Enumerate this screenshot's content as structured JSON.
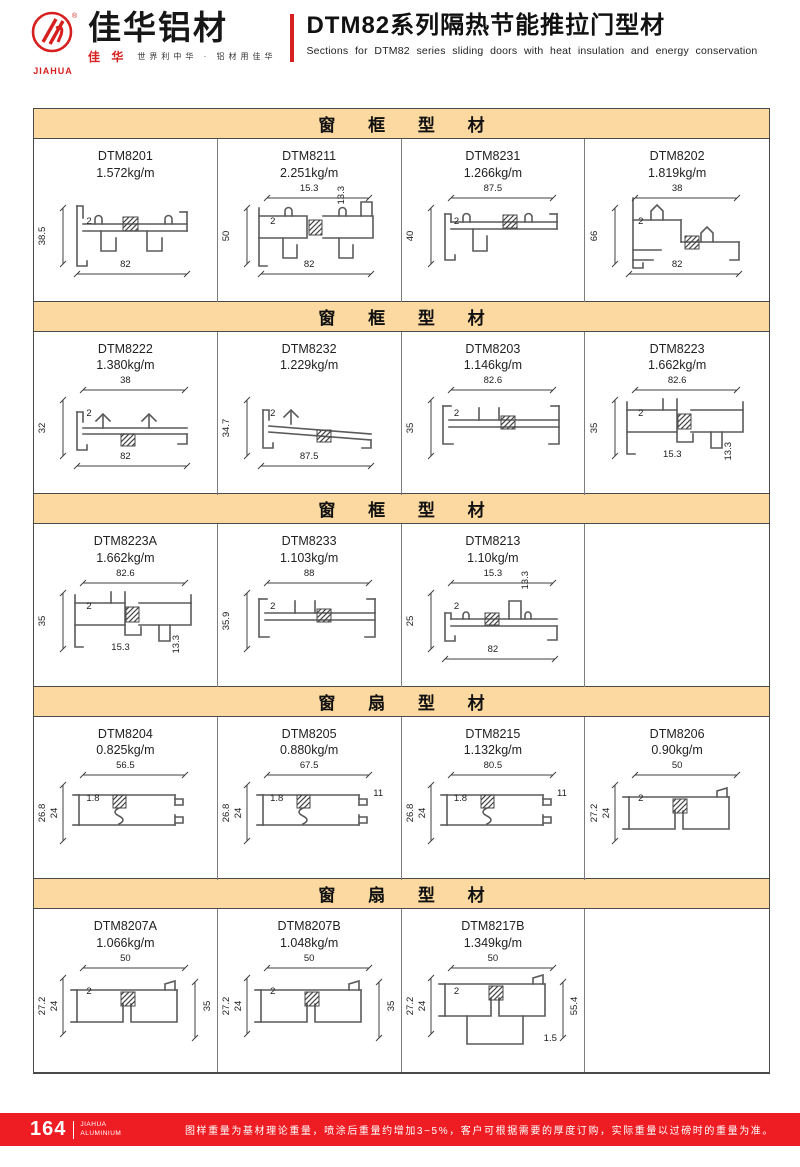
{
  "header": {
    "brand_en": "JIAHUA",
    "brand_cn": "佳华铝材",
    "brand_mark_cn": "佳 华",
    "tagline": "世界利中华 · 铝材用佳华",
    "title_cn": "DTM82系列隔热节能推拉门型材",
    "title_en": "Sections for DTM82 series sliding doors with heat insulation and energy conservation"
  },
  "sections": [
    {
      "title": "窗 框 型 材",
      "cells": [
        {
          "model": "DTM8201",
          "weight": "1.572kg/m",
          "shape": "trackA",
          "dims": [
            {
              "pos": "left",
              "v": "38.5"
            },
            {
              "pos": "inner",
              "v": "2"
            },
            {
              "pos": "bottom",
              "v": "82"
            }
          ]
        },
        {
          "model": "DTM8211",
          "weight": "2.251kg/m",
          "shape": "sillTop",
          "dims": [
            {
              "pos": "top",
              "v": "15.3"
            },
            {
              "pos": "top2",
              "v": "13.3"
            },
            {
              "pos": "inner",
              "v": "2"
            },
            {
              "pos": "left",
              "v": "50"
            },
            {
              "pos": "bottom",
              "v": "82"
            }
          ]
        },
        {
          "model": "DTM8231",
          "weight": "1.266kg/m",
          "shape": "trackB",
          "dims": [
            {
              "pos": "top",
              "v": "87.5"
            },
            {
              "pos": "inner",
              "v": "2"
            },
            {
              "pos": "left",
              "v": "40"
            }
          ]
        },
        {
          "model": "DTM8202",
          "weight": "1.819kg/m",
          "shape": "stepTall",
          "dims": [
            {
              "pos": "top",
              "v": "38"
            },
            {
              "pos": "left",
              "v": "66"
            },
            {
              "pos": "inner",
              "v": "2"
            },
            {
              "pos": "bottom",
              "v": "82"
            }
          ]
        }
      ]
    },
    {
      "title": "窗 框 型 材",
      "cells": [
        {
          "model": "DTM8222",
          "weight": "1.380kg/m",
          "shape": "sillArrows",
          "dims": [
            {
              "pos": "top",
              "v": "38"
            },
            {
              "pos": "inner",
              "v": "2"
            },
            {
              "pos": "left",
              "v": "32"
            },
            {
              "pos": "bottom",
              "v": "82"
            }
          ]
        },
        {
          "model": "DTM8232",
          "weight": "1.229kg/m",
          "shape": "sillSlope",
          "dims": [
            {
              "pos": "left",
              "v": "34.7"
            },
            {
              "pos": "inner",
              "v": "2"
            },
            {
              "pos": "bottom",
              "v": "87.5"
            }
          ]
        },
        {
          "model": "DTM8203",
          "weight": "1.146kg/m",
          "shape": "flatWide",
          "dims": [
            {
              "pos": "top",
              "v": "82.6"
            },
            {
              "pos": "left",
              "v": "35"
            },
            {
              "pos": "inner",
              "v": "2"
            }
          ]
        },
        {
          "model": "DTM8223",
          "weight": "1.662kg/m",
          "shape": "boxNotch",
          "dims": [
            {
              "pos": "top",
              "v": "82.6"
            },
            {
              "pos": "left",
              "v": "35"
            },
            {
              "pos": "inner",
              "v": "2"
            },
            {
              "pos": "bottom2",
              "v": "15.3"
            },
            {
              "pos": "right2",
              "v": "13.3"
            }
          ]
        }
      ]
    },
    {
      "title": "窗 框 型 材",
      "cells": [
        {
          "model": "DTM8223A",
          "weight": "1.662kg/m",
          "shape": "boxNotch",
          "dims": [
            {
              "pos": "top",
              "v": "82.6"
            },
            {
              "pos": "left",
              "v": "35"
            },
            {
              "pos": "inner",
              "v": "2"
            },
            {
              "pos": "bottom2",
              "v": "15.3"
            },
            {
              "pos": "right2",
              "v": "13.3"
            }
          ]
        },
        {
          "model": "DTM8233",
          "weight": "1.103kg/m",
          "shape": "flatWide",
          "dims": [
            {
              "pos": "top",
              "v": "88"
            },
            {
              "pos": "left",
              "v": "35.9"
            },
            {
              "pos": "inner",
              "v": "2"
            }
          ]
        },
        {
          "model": "DTM8213",
          "weight": "1.10kg/m",
          "shape": "trackLow",
          "dims": [
            {
              "pos": "top",
              "v": "15.3"
            },
            {
              "pos": "top2",
              "v": "13.3"
            },
            {
              "pos": "left",
              "v": "25"
            },
            {
              "pos": "inner",
              "v": "2"
            },
            {
              "pos": "bottom",
              "v": "82"
            }
          ]
        }
      ]
    },
    {
      "title": "窗 扇 型 材",
      "cells": [
        {
          "model": "DTM8204",
          "weight": "0.825kg/m",
          "shape": "sashRail",
          "dims": [
            {
              "pos": "top",
              "v": "56.5"
            },
            {
              "pos": "left",
              "v": "26.8"
            },
            {
              "pos": "left2",
              "v": "24"
            },
            {
              "pos": "inner",
              "v": "1.8"
            }
          ]
        },
        {
          "model": "DTM8205",
          "weight": "0.880kg/m",
          "shape": "sashRail",
          "dims": [
            {
              "pos": "top",
              "v": "67.5"
            },
            {
              "pos": "left",
              "v": "26.8"
            },
            {
              "pos": "left2",
              "v": "24"
            },
            {
              "pos": "inner",
              "v": "1.8"
            },
            {
              "pos": "right3",
              "v": "11"
            }
          ]
        },
        {
          "model": "DTM8215",
          "weight": "1.132kg/m",
          "shape": "sashRail",
          "dims": [
            {
              "pos": "top",
              "v": "80.5"
            },
            {
              "pos": "left",
              "v": "26.8"
            },
            {
              "pos": "left2",
              "v": "24"
            },
            {
              "pos": "inner",
              "v": "1.8"
            },
            {
              "pos": "right3",
              "v": "11"
            }
          ]
        },
        {
          "model": "DTM8206",
          "weight": "0.90kg/m",
          "shape": "sashBox",
          "dims": [
            {
              "pos": "top",
              "v": "50"
            },
            {
              "pos": "left",
              "v": "27.2"
            },
            {
              "pos": "left2",
              "v": "24"
            },
            {
              "pos": "inner",
              "v": "2"
            }
          ]
        }
      ]
    },
    {
      "title": "窗 扇 型 材",
      "cells": [
        {
          "model": "DTM8207A",
          "weight": "1.066kg/m",
          "shape": "sashBox",
          "dims": [
            {
              "pos": "top",
              "v": "50"
            },
            {
              "pos": "left",
              "v": "27.2"
            },
            {
              "pos": "left2",
              "v": "24"
            },
            {
              "pos": "inner",
              "v": "2"
            },
            {
              "pos": "right",
              "v": "35"
            }
          ]
        },
        {
          "model": "DTM8207B",
          "weight": "1.048kg/m",
          "shape": "sashBox",
          "dims": [
            {
              "pos": "top",
              "v": "50"
            },
            {
              "pos": "left",
              "v": "27.2"
            },
            {
              "pos": "left2",
              "v": "24"
            },
            {
              "pos": "inner",
              "v": "2"
            },
            {
              "pos": "right",
              "v": "35"
            }
          ]
        },
        {
          "model": "DTM8217B",
          "weight": "1.349kg/m",
          "shape": "sashDeep",
          "dims": [
            {
              "pos": "top",
              "v": "50"
            },
            {
              "pos": "left",
              "v": "27.2"
            },
            {
              "pos": "left2",
              "v": "24"
            },
            {
              "pos": "inner",
              "v": "2"
            },
            {
              "pos": "right",
              "v": "55.4"
            },
            {
              "pos": "br",
              "v": "1.5"
            }
          ]
        }
      ]
    }
  ],
  "footer": {
    "page_number": "164",
    "brand_line1": "JIAHUA",
    "brand_line2": "ALUMINIUM",
    "note": "图样重量为基材理论重量，喷涂后重量约增加3~5%，客户可根据需要的厚度订购，实际重量以过磅时的重量为准。"
  },
  "colors": {
    "accent_red": "#ee1d23",
    "section_header_bg": "#fbd9a0",
    "drawing_line": "#5a5a5a"
  }
}
